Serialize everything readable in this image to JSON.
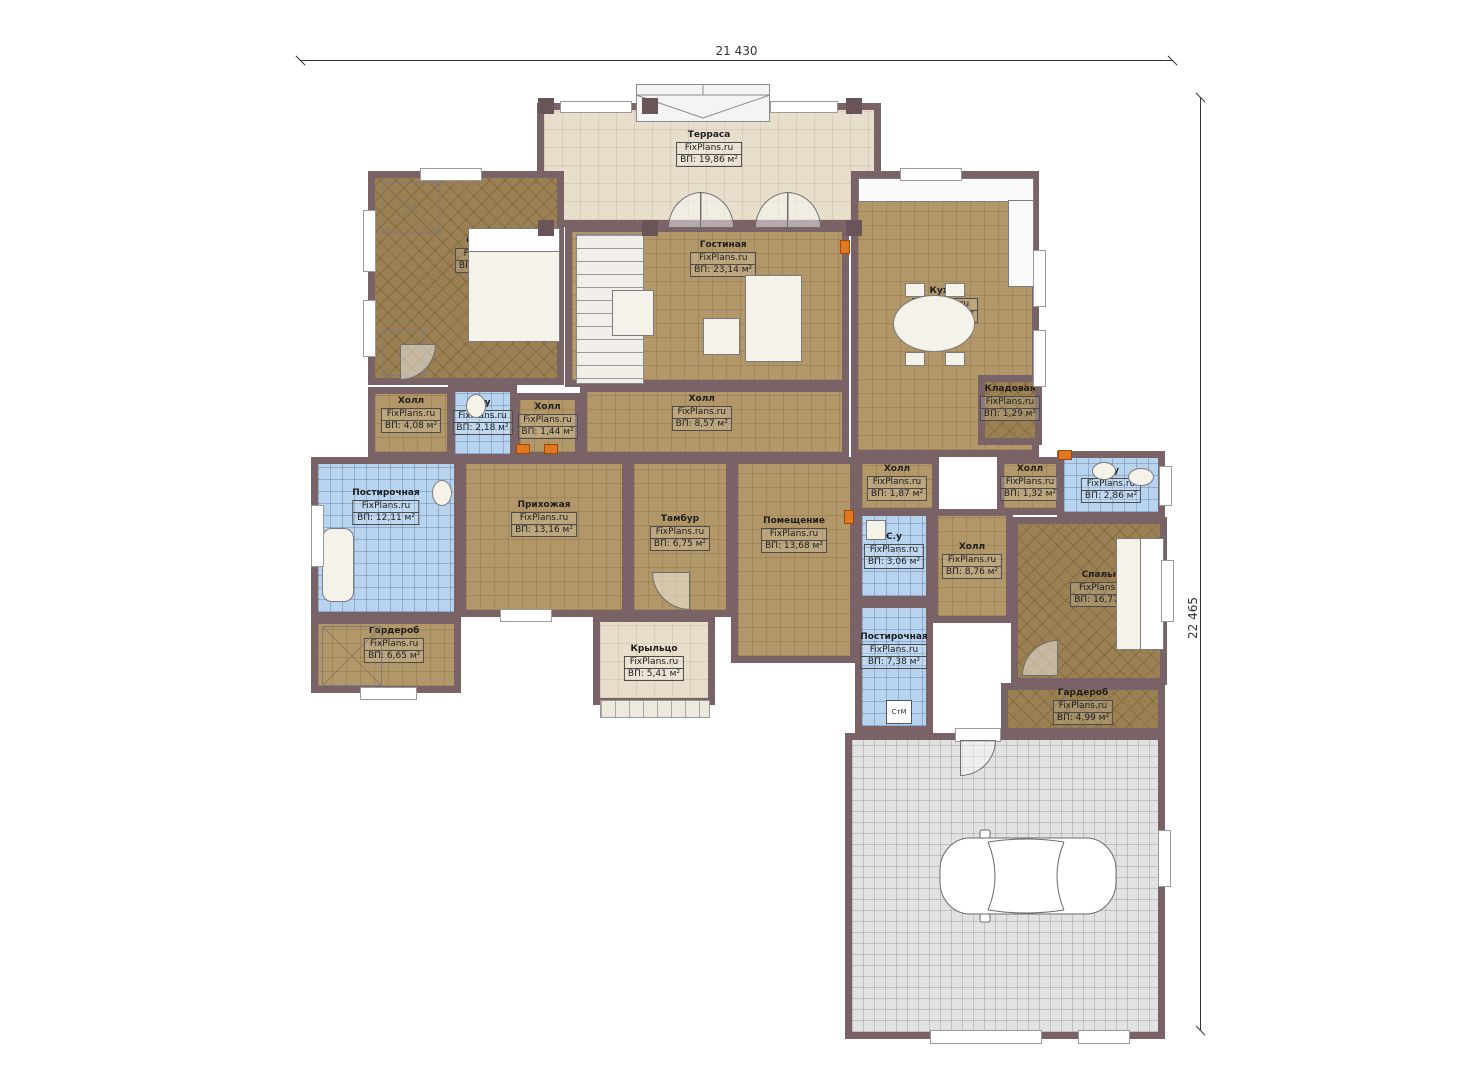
{
  "watermark": "FixPlans.ru",
  "dimensions": {
    "width_label": "21 430",
    "height_label": "22 465"
  },
  "rooms": [
    {
      "name": "Терраса",
      "area": "ВП: 19,86 м²"
    },
    {
      "name": "Спальня",
      "area": "ВП: 22,95 м²"
    },
    {
      "name": "Гостиная",
      "area": "ВП: 23,14 м²"
    },
    {
      "name": "Кухня",
      "area": "ВП: 25,56 м²"
    },
    {
      "name": "Холл",
      "area": "ВП: 4,08 м²"
    },
    {
      "name": "С.у",
      "area": "ВП: 2,18 м²"
    },
    {
      "name": "Холл",
      "area": "ВП: 1,44 м²"
    },
    {
      "name": "Холл",
      "area": "ВП: 8,57 м²"
    },
    {
      "name": "Кладовая",
      "area": "ВП: 1,29 м²"
    },
    {
      "name": "Постирочная",
      "area": "ВП: 12,11 м²"
    },
    {
      "name": "Прихожая",
      "area": "ВП: 13,16 м²"
    },
    {
      "name": "Тамбур",
      "area": "ВП: 6,75 м²"
    },
    {
      "name": "Помещение",
      "area": "ВП: 13,68 м²"
    },
    {
      "name": "Холл",
      "area": "ВП: 1,87 м²"
    },
    {
      "name": "Холл",
      "area": "ВП: 1,32 м²"
    },
    {
      "name": "С.у",
      "area": "ВП: 2,86 м²"
    },
    {
      "name": "С.у",
      "area": "ВП: 3,06 м²"
    },
    {
      "name": "Холл",
      "area": "ВП: 8,76 м²"
    },
    {
      "name": "Спальня",
      "area": "ВП: 16,77 м²"
    },
    {
      "name": "Постирочная",
      "area": "ВП: 7,38 м²"
    },
    {
      "name": "Гардероб",
      "area": "ВП: 6,65 м²"
    },
    {
      "name": "Крыльцо",
      "area": "ВП: 5,41 м²"
    },
    {
      "name": "Гардероб",
      "area": "ВП: 4,99 м²"
    },
    {
      "name": "Гараж",
      "area": "ВП: 43,31 м²"
    }
  ],
  "fixtures": {
    "washing_machine": "СтМ"
  },
  "colors": {
    "wall": "#796366",
    "floor_wood": "#b29869",
    "floor_dark_wood": "#9a8052",
    "floor_blue_tile": "#b7d3ee",
    "floor_terrace": "#e8decc",
    "floor_garage": "#e2e2e2",
    "marker_orange": "#e07820"
  }
}
